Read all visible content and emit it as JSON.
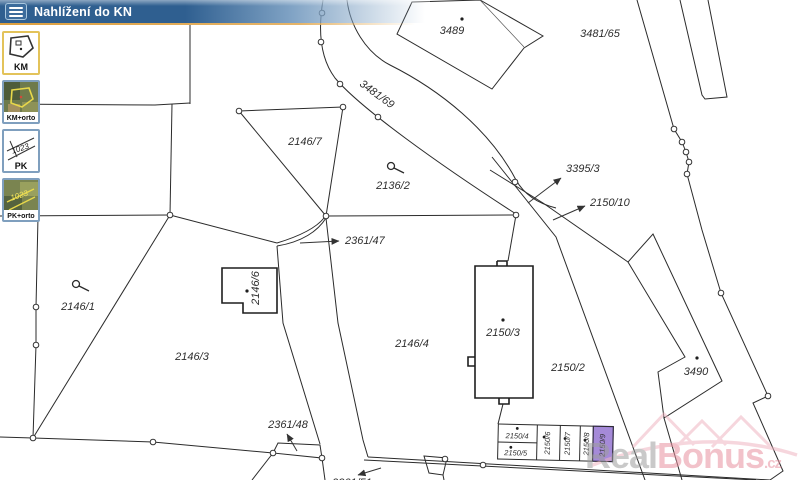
{
  "header": {
    "title": "Nahlížení do KN"
  },
  "layer_buttons": [
    {
      "label": "KM",
      "selected": true
    },
    {
      "label": "KM+orto",
      "selected": false
    },
    {
      "label": "PK",
      "selected": false
    },
    {
      "label": "PK+orto",
      "selected": false
    }
  ],
  "map": {
    "labels": {
      "p3489": "3489",
      "p3481_65": "3481/65",
      "p3481_69": "3481/69",
      "p2146_7": "2146/7",
      "p2136_2": "2136/2",
      "p3395_3": "3395/3",
      "p2150_10": "2150/10",
      "p2361_47": "2361/47",
      "p2146_1": "2146/1",
      "p2146_6": "2146/6",
      "p2146_3": "2146/3",
      "p2146_4": "2146/4",
      "p2150_3": "2150/3",
      "p2150_2": "2150/2",
      "p3490": "3490",
      "p2361_48": "2361/48",
      "p2361_51": "2361/51",
      "p2150_4": "2150/4",
      "p2150_5": "2150/5",
      "p2150_6": "2150/6",
      "p2150_7": "2150/7",
      "p2150_8": "2150/8",
      "p2150_9": "2150/9"
    },
    "selected_parcel": {
      "number": "2150/9",
      "fill": "#a58ad8"
    }
  },
  "watermark": {
    "gray": "Real",
    "pink": "Bonus",
    "suffix": ".cz"
  },
  "colors": {
    "header_blue": "#2f5f90",
    "header_accent": "#dd9f3e",
    "selected_button_border": "#e3c35a",
    "button_border": "#7f9fbe",
    "highlight_purple": "#a58ad8",
    "watermark_pink": "#e9919f"
  }
}
